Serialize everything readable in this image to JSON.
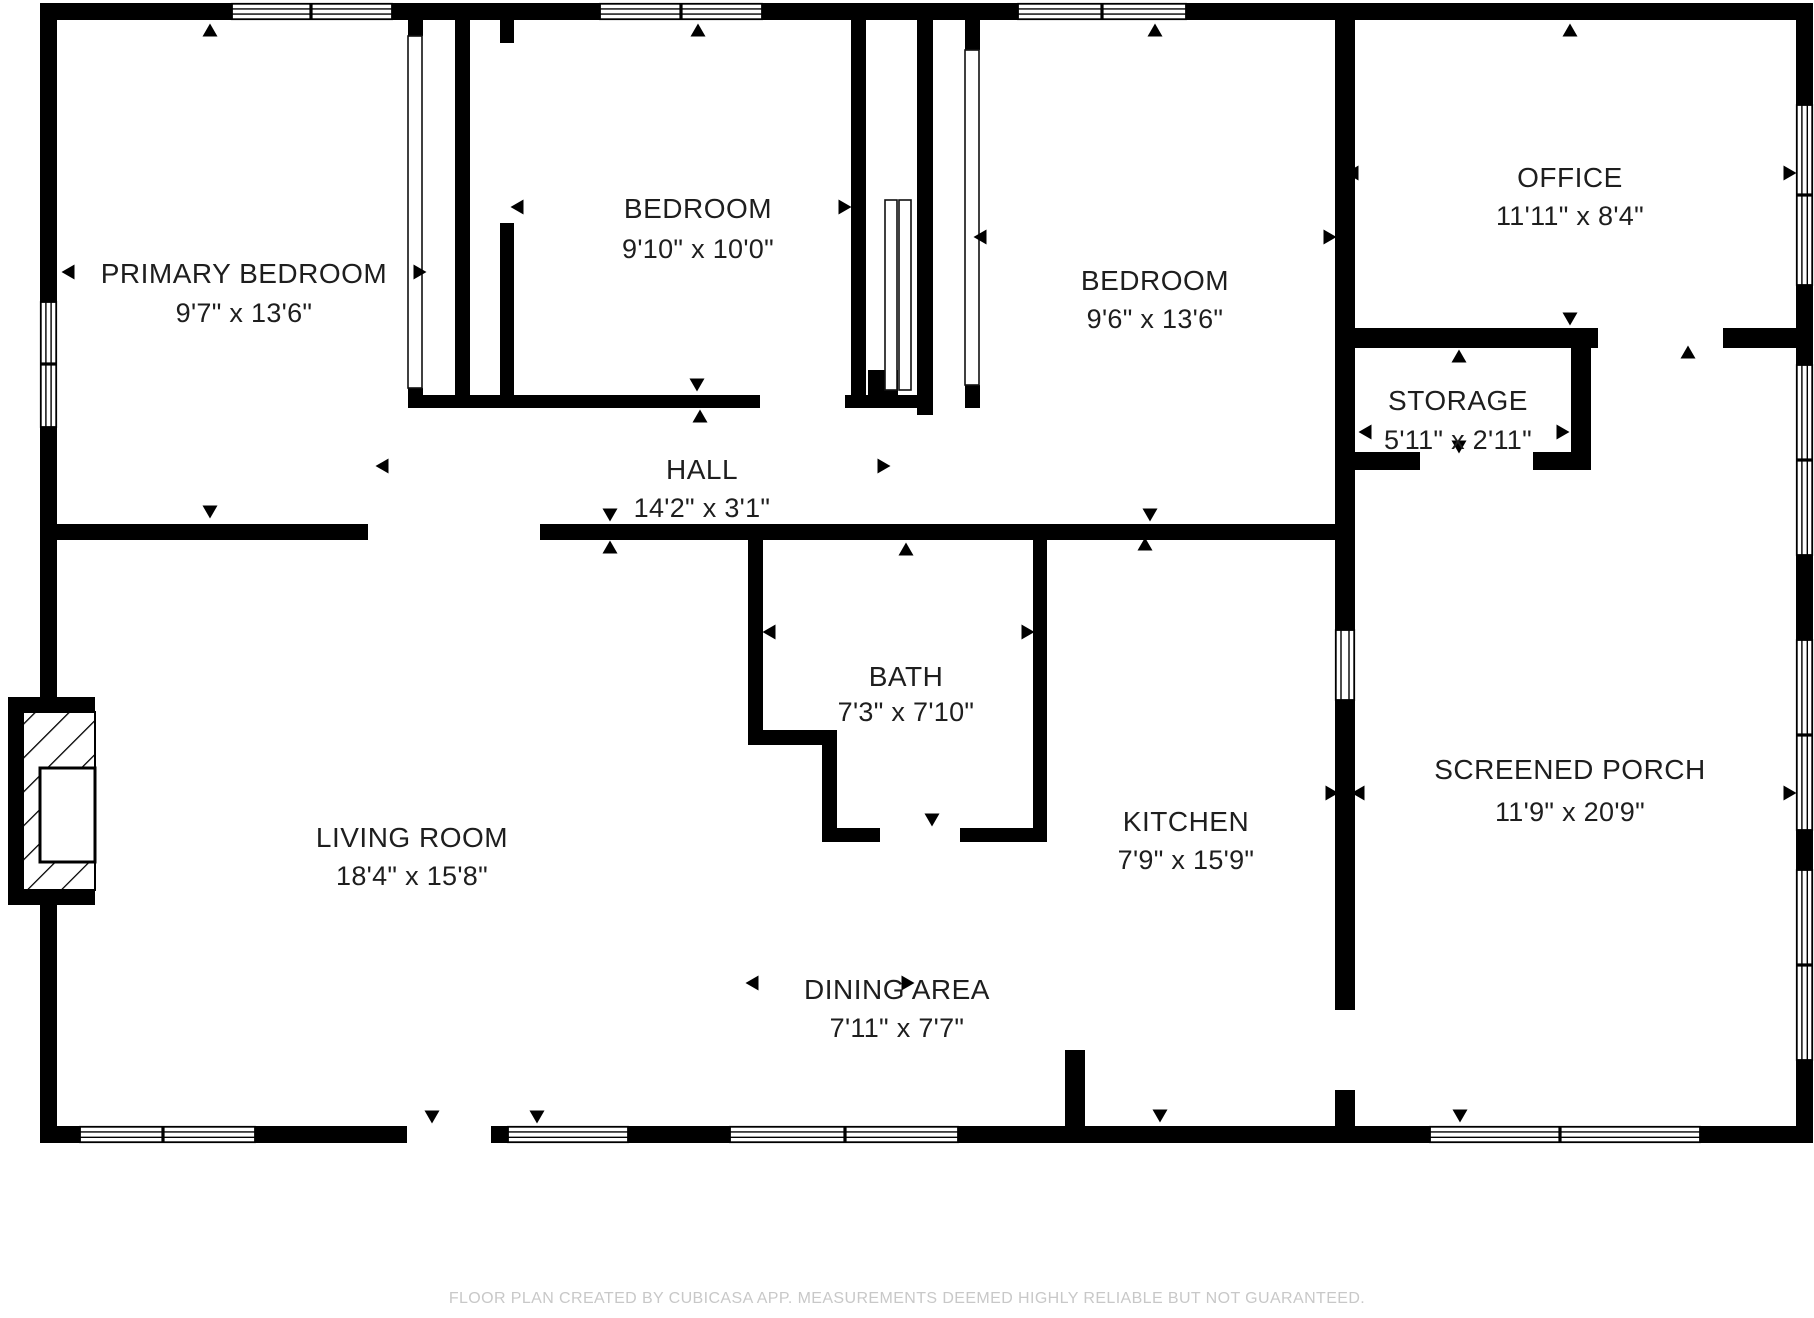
{
  "rooms": {
    "primary_bedroom": {
      "name": "PRIMARY BEDROOM",
      "dims": "9'7\" x 13'6\""
    },
    "bedroom_1": {
      "name": "BEDROOM",
      "dims": "9'10\" x 10'0\""
    },
    "bedroom_2": {
      "name": "BEDROOM",
      "dims": "9'6\" x 13'6\""
    },
    "office": {
      "name": "OFFICE",
      "dims": "11'11\" x 8'4\""
    },
    "storage": {
      "name": "STORAGE",
      "dims": "5'11\" x 2'11\""
    },
    "hall": {
      "name": "HALL",
      "dims": "14'2\" x 3'1\""
    },
    "bath": {
      "name": "BATH",
      "dims": "7'3\" x 7'10\""
    },
    "living_room": {
      "name": "LIVING ROOM",
      "dims": "18'4\" x 15'8\""
    },
    "kitchen": {
      "name": "KITCHEN",
      "dims": "7'9\" x 15'9\""
    },
    "dining_area": {
      "name": "DINING AREA",
      "dims": "7'11\" x 7'7\""
    },
    "screened_porch": {
      "name": "SCREENED PORCH",
      "dims": "11'9\" x 20'9\""
    }
  },
  "footer": {
    "disclaimer": "FLOOR PLAN CREATED BY CUBICASA APP. MEASUREMENTS DEEMED HIGHLY RELIABLE BUT NOT GUARANTEED."
  },
  "colors": {
    "wall": "#000000",
    "background": "#ffffff",
    "label": "#1e1e1e",
    "disclaimer": "#c8c8c8"
  }
}
